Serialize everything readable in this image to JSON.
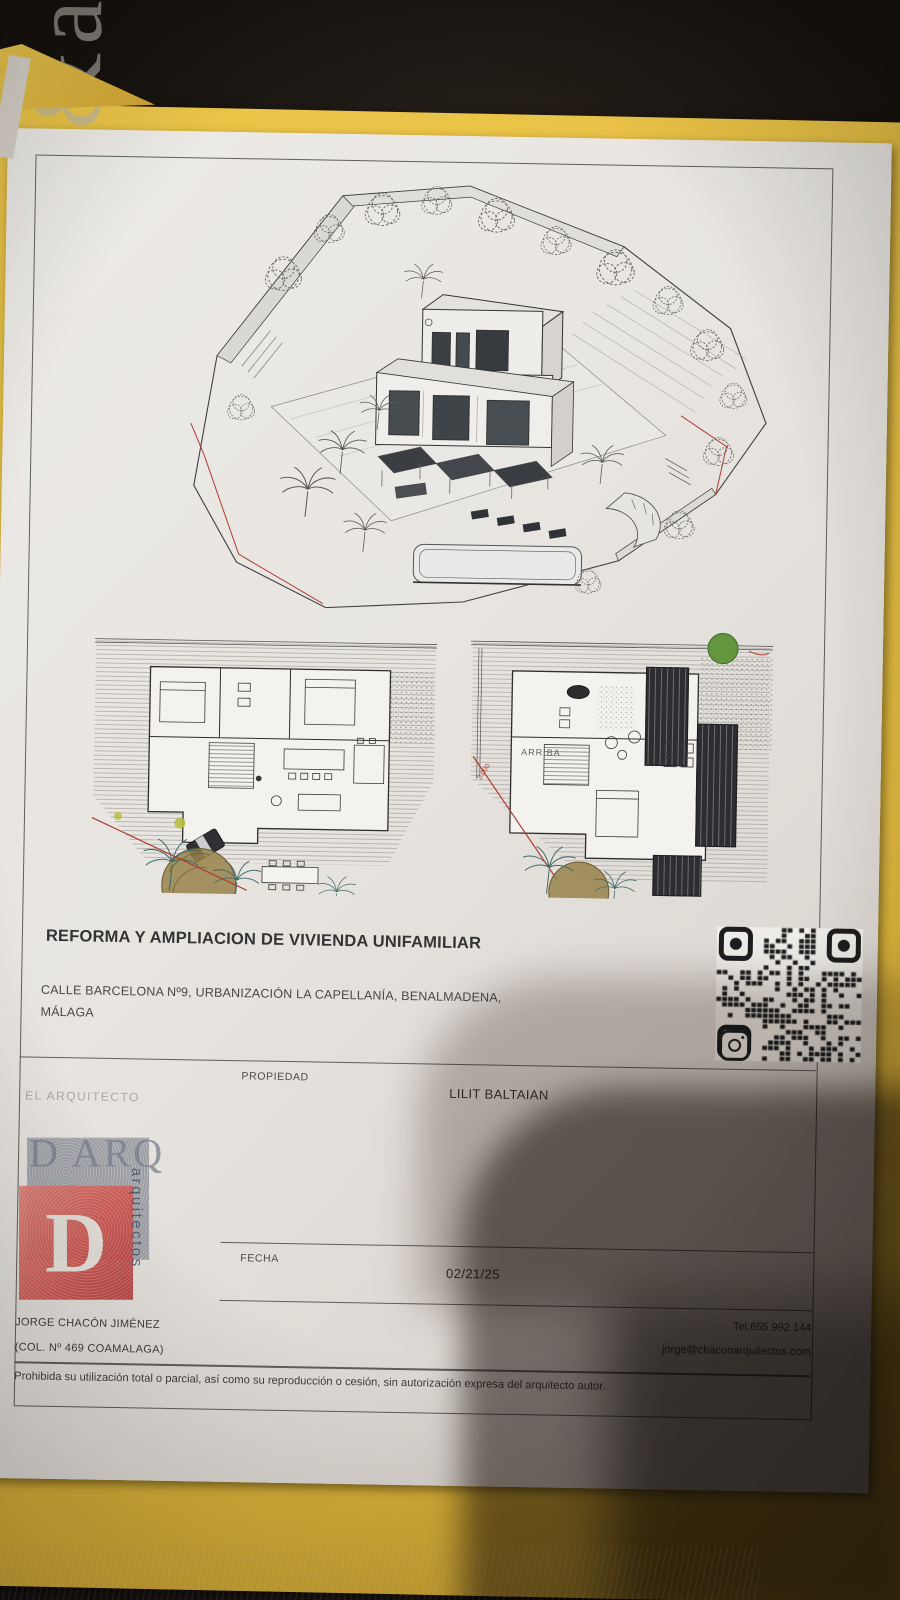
{
  "sheet": {
    "title": "REFORMA Y AMPLIACION DE VIVIENDA UNIFAMILIAR",
    "address_line1": "CALLE BARCELONA Nº9, URBANIZACIÓN LA CAPELLANÍA, BENALMADENA,",
    "address_line2": "MÁLAGA",
    "propiedad_label": "PROPIEDAD",
    "propiedad_value": "LILIT BALTAIAN",
    "arquitecto_label": "EL ARQUITECTO",
    "fecha_label": "FECHA",
    "fecha_value": "02/21/25",
    "architect_name": "JORGE CHACÓN JIMÉNEZ",
    "architect_college": "(COL. Nº 469 COAMALAGA)",
    "tel": "Tel.655 992 144",
    "email": "jorge@chaconarquitectos.com",
    "disclaimer": "Prohibida su utilización total o parcial, así como su reproducción o cesión, sin autorización expresa del arquitecto autor.",
    "watermark": "&arquitectos"
  },
  "stamp": {
    "top_text": "D ARQ",
    "monogram": "D",
    "side_text": "arquitectos"
  },
  "plans": {
    "arriba_label": "ARRIBA",
    "dimension_label": "3.000"
  },
  "icons": [
    {
      "name": "qr-code",
      "meaning": "QR code printed on sheet"
    },
    {
      "name": "instagram-icon",
      "meaning": "Instagram badge on QR code"
    }
  ],
  "colors": {
    "folder_yellow": "#e3bc42",
    "paper": "#e9e6e2",
    "stamp_red": "#c94f4c",
    "boundary_red": "#b23a32",
    "palm_teal": "#3e6b68",
    "table_dark": "#171310",
    "ink": "#3b3b3b"
  }
}
